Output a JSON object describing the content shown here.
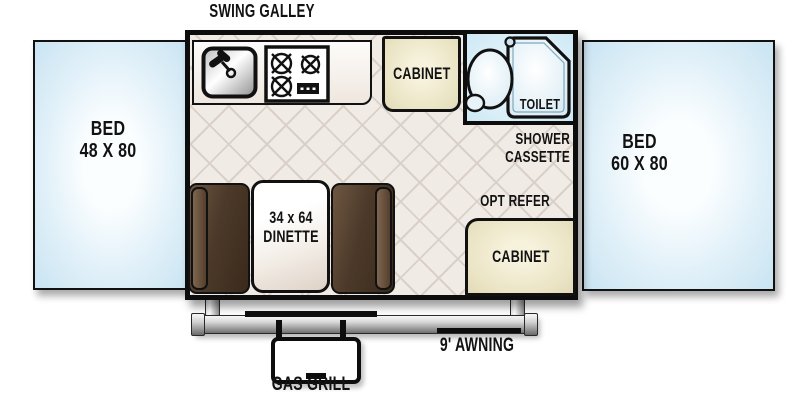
{
  "floorplan": {
    "galley_label": "SWING GALLEY",
    "bed_left": {
      "name": "BED",
      "size": "48 X 80"
    },
    "bed_right": {
      "name": "BED",
      "size": "60 X 80"
    },
    "cabinet_top_label": "CABINET",
    "cabinet_bottom_label": "CABINET",
    "toilet_label": "TOILET",
    "shower_line1": "SHOWER",
    "shower_line2": "CASSETTE",
    "opt_refer_label": "OPT REFER",
    "dinette_size": "34 x 64",
    "dinette_label": "DINETTE",
    "gas_grill_label": "GAS GRILL",
    "awning_label": "9' AWNING"
  },
  "icons": {
    "sink": "sink-faucet-icon",
    "stove": "stove-burners-icon",
    "toilet": "toilet-icon",
    "shower_head": "shower-head-icon",
    "shower_pan": "shower-pan-icon"
  },
  "colors": {
    "wall": "#0d0d0d",
    "bed_fill": "#cfe7f4",
    "floor_fill": "#f1ebe5",
    "floor_line": "#d9d1c9",
    "cabinet_fill": "#eae3c3",
    "bathroom_fill": "#cfe9f6",
    "bench_fill": "#4c3929",
    "metal": "#9a9a9a",
    "text": "#121212"
  }
}
